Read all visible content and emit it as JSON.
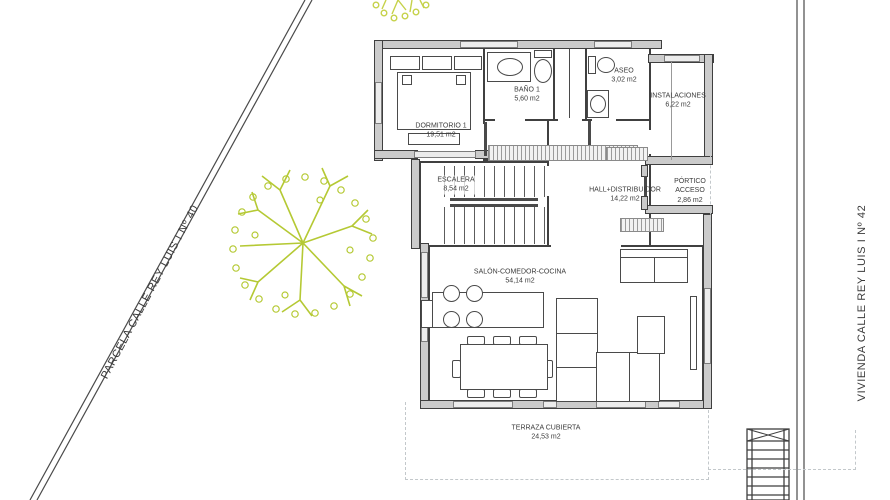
{
  "site": {
    "parcel_label": "PARCELA CALLE REY LUIS I Nº 40",
    "vivienda_label": "VIVIENDA CALLE REY LUIS I Nº 42"
  },
  "rooms": [
    {
      "id": "dormitorio-1",
      "name": "DORMITORIO 1",
      "area": "19,51 m2"
    },
    {
      "id": "bano-1",
      "name": "BAÑO 1",
      "area": "5,60 m2"
    },
    {
      "id": "aseo",
      "name": "ASEO",
      "area": "3,02 m2"
    },
    {
      "id": "instalaciones",
      "name": "INSTALACIONES",
      "area": "6,22 m2"
    },
    {
      "id": "escalera",
      "name": "ESCALERA",
      "area": "8,54 m2"
    },
    {
      "id": "hall-distribuidor",
      "name": "HALL+DISTRIBUIDOR",
      "area": "14,22 m2"
    },
    {
      "id": "portico-acceso",
      "name": "PÓRTICO ACCESO",
      "area": "2,86 m2"
    },
    {
      "id": "salon-comedor-cocina",
      "name": "SALÓN-COMEDOR-COCINA",
      "area": "54,14 m2"
    },
    {
      "id": "terraza-cubierta",
      "name": "TERRAZA CUBIERTA",
      "area": "24,53 m2"
    }
  ],
  "colors": {
    "wall_fill": "#cbcbcb",
    "wall_stroke": "#3f3f3f",
    "tree_green": "#b5c934",
    "boundary_line": "#4a4a4a",
    "dashed_line": "#c3c8cb",
    "window_fill": "#ececec",
    "label_text": "#3b3b3b"
  }
}
